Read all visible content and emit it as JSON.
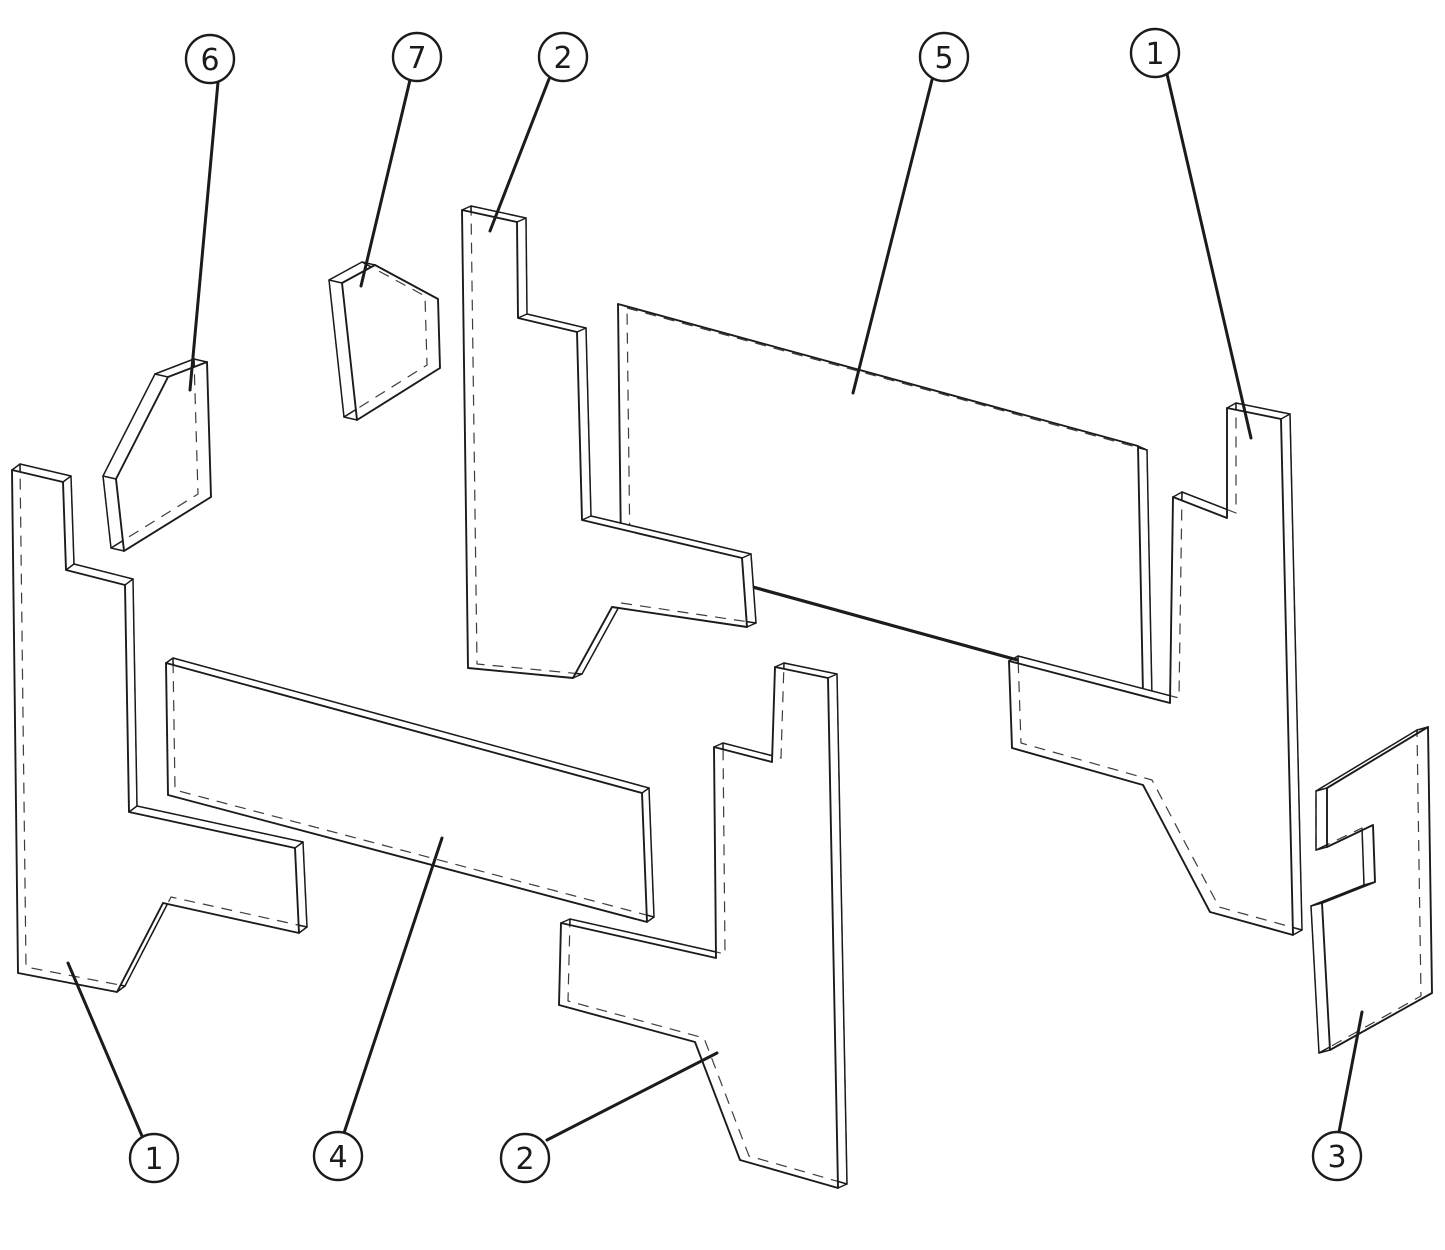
{
  "figure": {
    "width": 1445,
    "height": 1250,
    "background": "#ffffff",
    "line_color": "#1b1b1b",
    "outline_width": 1.9,
    "thin_width": 1.5,
    "leader_width": 3,
    "circle_stroke_width": 2.4,
    "circle_radius": 24,
    "number_font_size": 30,
    "hidden_dash": "11 8"
  },
  "diagram": {
    "kind": "exploded-parts-diagram",
    "parts": [
      {
        "name": "rear-panel-large",
        "item_number": "5",
        "thickness": [
          9,
          4
        ],
        "points": [
          [
            618,
            304
          ],
          [
            1138,
            446
          ],
          [
            1143,
            694
          ],
          [
            621,
            550
          ]
        ]
      },
      {
        "name": "rear-panel-lower",
        "item_number": "4",
        "thickness": [
          7,
          -5
        ],
        "points": [
          [
            166,
            663
          ],
          [
            642,
            793
          ],
          [
            647,
            922
          ],
          [
            168,
            795
          ]
        ]
      },
      {
        "name": "corner-brick-left",
        "item_number": "6",
        "thickness": [
          -13,
          -3
        ],
        "points": [
          [
            168,
            377
          ],
          [
            207,
            362
          ],
          [
            211,
            497
          ],
          [
            124,
            551
          ],
          [
            116,
            479
          ]
        ]
      },
      {
        "name": "corner-brick-center",
        "item_number": "7",
        "thickness": [
          -13,
          -3
        ],
        "points": [
          [
            342,
            283
          ],
          [
            375,
            265
          ],
          [
            438,
            299
          ],
          [
            440,
            368
          ],
          [
            357,
            420
          ]
        ]
      },
      {
        "name": "side-panel-upper-middle",
        "item_number": "2",
        "thickness": [
          9,
          -4
        ],
        "points": [
          [
            462,
            210
          ],
          [
            517,
            222
          ],
          [
            518,
            318
          ],
          [
            577,
            332
          ],
          [
            582,
            520
          ],
          [
            742,
            558
          ],
          [
            747,
            627
          ],
          [
            612,
            607
          ],
          [
            573,
            678
          ],
          [
            468,
            668
          ]
        ]
      },
      {
        "name": "side-panel-left",
        "item_number": "1",
        "thickness": [
          8,
          -6
        ],
        "points": [
          [
            12,
            470
          ],
          [
            63,
            482
          ],
          [
            66,
            570
          ],
          [
            125,
            585
          ],
          [
            129,
            812
          ],
          [
            295,
            848
          ],
          [
            299,
            933
          ],
          [
            163,
            903
          ],
          [
            117,
            992
          ],
          [
            18,
            973
          ]
        ]
      },
      {
        "name": "side-panel-right",
        "item_number": "1",
        "thickness": [
          9,
          -5
        ],
        "points": [
          [
            1227,
            408
          ],
          [
            1281,
            419
          ],
          [
            1293,
            935
          ],
          [
            1210,
            912
          ],
          [
            1143,
            785
          ],
          [
            1012,
            748
          ],
          [
            1009,
            661
          ],
          [
            1170,
            703
          ],
          [
            1173,
            497
          ],
          [
            1227,
            518
          ]
        ]
      },
      {
        "name": "end-panel-notched-right",
        "item_number": "3",
        "thickness": [
          -11,
          3
        ],
        "points": [
          [
            1327,
            788
          ],
          [
            1428,
            727
          ],
          [
            1432,
            993
          ],
          [
            1330,
            1050
          ],
          [
            1322,
            903
          ],
          [
            1375,
            882
          ],
          [
            1373,
            825
          ],
          [
            1327,
            847
          ]
        ]
      },
      {
        "name": "side-panel-lower-middle",
        "item_number": "2",
        "thickness": [
          9,
          -4
        ],
        "points": [
          [
            775,
            667
          ],
          [
            828,
            678
          ],
          [
            838,
            1188
          ],
          [
            740,
            1160
          ],
          [
            695,
            1042
          ],
          [
            559,
            1005
          ],
          [
            561,
            923
          ],
          [
            716,
            958
          ],
          [
            714,
            747
          ],
          [
            772,
            762
          ]
        ]
      }
    ],
    "callouts": [
      {
        "label": "6",
        "cx": 210,
        "cy": 59,
        "leader": [
          218,
          82,
          190,
          390
        ],
        "target": "corner-brick-left"
      },
      {
        "label": "7",
        "cx": 417,
        "cy": 57,
        "leader": [
          410,
          80,
          361,
          286
        ],
        "target": "corner-brick-center"
      },
      {
        "label": "2",
        "cx": 563,
        "cy": 57,
        "leader": [
          549,
          79,
          490,
          231
        ],
        "target": "side-panel-upper-middle"
      },
      {
        "label": "5",
        "cx": 944,
        "cy": 57,
        "leader": [
          932,
          80,
          853,
          393
        ],
        "target": "rear-panel-large"
      },
      {
        "label": "1",
        "cx": 1155,
        "cy": 53,
        "leader": [
          1167,
          74,
          1251,
          438
        ],
        "target": "side-panel-right"
      },
      {
        "label": "1",
        "cx": 154,
        "cy": 1158,
        "leader": [
          142,
          1136,
          68,
          963
        ],
        "target": "side-panel-left"
      },
      {
        "label": "4",
        "cx": 338,
        "cy": 1156,
        "leader": [
          344,
          1133,
          442,
          838
        ],
        "target": "rear-panel-lower"
      },
      {
        "label": "2",
        "cx": 525,
        "cy": 1158,
        "leader": [
          547,
          1140,
          717,
          1053
        ],
        "target": "side-panel-lower-middle"
      },
      {
        "label": "3",
        "cx": 1337,
        "cy": 1156,
        "leader": [
          1339,
          1132,
          1362,
          1012
        ],
        "target": "end-panel-notched-right"
      }
    ]
  }
}
